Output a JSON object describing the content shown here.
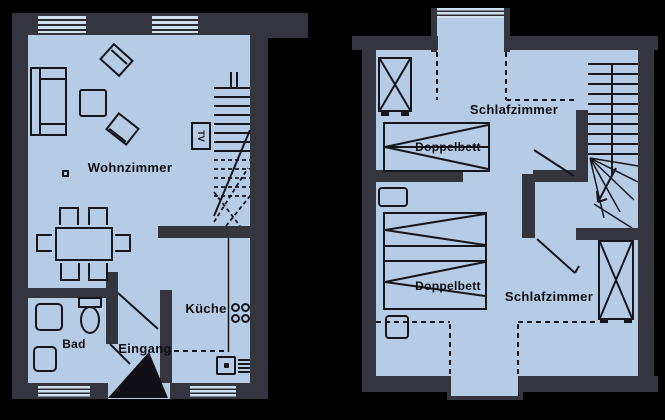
{
  "colors": {
    "background": "#000000",
    "wall": "#35353f",
    "floor": "#b6cce4",
    "line": "#16161e",
    "window_stripe": "#cfe0f0"
  },
  "ground_floor": {
    "living_room_label": "Wohnzimmer",
    "kitchen_label": "Küche",
    "bath_label": "Bad",
    "entrance_label": "Eingang",
    "tv_label": "TV"
  },
  "upper_floor": {
    "bedroom1_label": "Schlafzimmer",
    "bed1_label": "Doppelbett",
    "bedroom2_label": "Schlafzimmer",
    "bed2_label": "Doppelbett"
  }
}
